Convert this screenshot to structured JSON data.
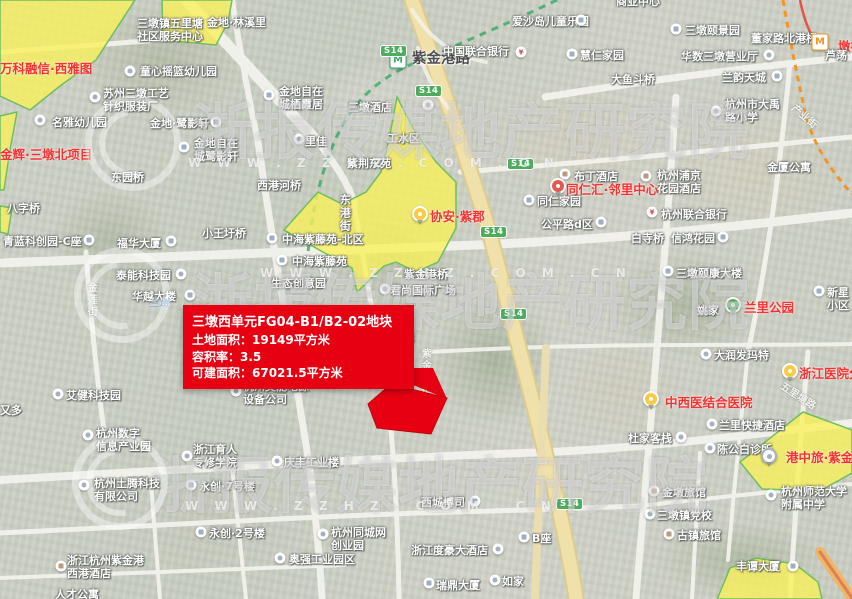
{
  "colors": {
    "zone_fill": "#f8ee3c",
    "zone_stroke": "#56b344",
    "parcel_red": "#e60012",
    "metro_line_green": "#1d9e53",
    "metro_line_orange": "#f08300",
    "metro_line_red": "#e3342b",
    "shield_green": "#2f9e41",
    "highway_yellow": "#eedc9d"
  },
  "infobox": {
    "title": "三墩西单元FG04-B1/B2-02地块",
    "lines": [
      "土地面积：19149平方米",
      "容积率：3.5",
      "可建面积：67021.5平方米"
    ]
  },
  "watermark": {
    "brand": "浙报传媒地产研究院",
    "url": "W W W . Z Z H Z . C O M . C N",
    "rows": [
      {
        "x": 192,
        "y": 82
      },
      {
        "x": 192,
        "y": 253
      },
      {
        "x": 150,
        "y": 436
      }
    ],
    "urls": [
      {
        "x": 188,
        "y": 156
      },
      {
        "x": 260,
        "y": 266
      },
      {
        "x": 185,
        "y": 499
      }
    ],
    "logos": [
      {
        "x": 133,
        "y": 143
      },
      {
        "x": 122,
        "y": 295
      },
      {
        "x": 120,
        "y": 482
      }
    ]
  },
  "map": {
    "road_shield": "S14",
    "pin_glyphs": {
      "bank": "¥",
      "mg": "M",
      "mo": "M"
    },
    "shields": [
      {
        "x": 380,
        "y": 45
      },
      {
        "x": 415,
        "y": 85
      },
      {
        "x": 507,
        "y": 158
      },
      {
        "x": 480,
        "y": 226
      },
      {
        "x": 500,
        "y": 308
      },
      {
        "x": 556,
        "y": 498
      }
    ],
    "zones": [
      {
        "points": "0,0 135,0 96,60 60,86 30,110 0,96"
      },
      {
        "points": "0,116 17,112 10,150 4,190 0,190"
      },
      {
        "points": "0,206 12,208 8,234 0,232"
      },
      {
        "points": "162,0 232,0 228,22 216,45 163,40"
      },
      {
        "points": "397,97 413,128 436,162 456,182 456,228 438,262 416,272 396,262 384,266 357,292 352,268 330,256 284,230 318,192 342,204 366,192 381,172 389,140"
      },
      {
        "points": "803,412 852,430 852,473 820,491 762,489 740,462"
      },
      {
        "points": "718,597 730,568 756,558 795,564 818,582 822,599 718,599"
      }
    ],
    "parcel": {
      "name": "三墩西单元FG04-B1/B2-02地块",
      "points": "368,404 391,384 447,398 431,434 377,428",
      "tail": "390,368 433,368 447,399 406,382"
    },
    "labels": [
      {
        "t": "万科融信·西雅图",
        "x": 0,
        "y": 61,
        "c": "r"
      },
      {
        "t": "金辉·三墩北项目",
        "x": 0,
        "y": 147,
        "c": "r"
      },
      {
        "t": "协安·紫郡",
        "x": 430,
        "y": 209,
        "c": "r"
      },
      {
        "t": "同仁汇·邻里中心",
        "x": 566,
        "y": 182,
        "c": "r"
      },
      {
        "t": "兰里公园",
        "x": 744,
        "y": 300,
        "c": "r"
      },
      {
        "t": "浙江医院分院",
        "x": 799,
        "y": 366,
        "c": "r"
      },
      {
        "t": "中西医结合医院",
        "x": 665,
        "y": 395,
        "c": "r"
      },
      {
        "t": "港中旅·紫金湾",
        "x": 786,
        "y": 450,
        "c": "r"
      },
      {
        "t": "墩祥街",
        "x": 838,
        "y": 39,
        "c": "r"
      },
      {
        "t": "紫金港路",
        "x": 412,
        "y": 51,
        "c": "st"
      },
      {
        "t": "三墩镇五里塘\n社区服务中心",
        "x": 137,
        "y": 17,
        "c": "p"
      },
      {
        "t": "金地·林溪里",
        "x": 207,
        "y": 16,
        "c": "p"
      },
      {
        "t": "童心摇篮幼儿园",
        "x": 140,
        "y": 65,
        "c": "p"
      },
      {
        "t": "苏州三墩工艺\n针织服装厂",
        "x": 103,
        "y": 87,
        "c": "p"
      },
      {
        "t": "名雅幼儿园",
        "x": 52,
        "y": 116,
        "c": "p"
      },
      {
        "t": "金地·鹭影轩",
        "x": 150,
        "y": 117,
        "c": "p"
      },
      {
        "t": "金地自在\n城鹭影轩",
        "x": 194,
        "y": 137,
        "c": "p"
      },
      {
        "t": "金地自在\n城栖霞居",
        "x": 279,
        "y": 85,
        "c": "p"
      },
      {
        "t": "东园桥",
        "x": 111,
        "y": 171,
        "c": "p"
      },
      {
        "t": "八字桥",
        "x": 7,
        "y": 202,
        "c": "p"
      },
      {
        "t": "青蓝科创园-C座",
        "x": 3,
        "y": 235,
        "c": "p"
      },
      {
        "t": "福华大厦",
        "x": 117,
        "y": 237,
        "c": "p"
      },
      {
        "t": "泰能科技园",
        "x": 116,
        "y": 269,
        "c": "p"
      },
      {
        "t": "华越大楼",
        "x": 132,
        "y": 290,
        "c": "p"
      },
      {
        "t": "小王圩桥",
        "x": 202,
        "y": 227,
        "c": "p"
      },
      {
        "t": "中海紫藤苑-北区",
        "x": 282,
        "y": 233,
        "c": "p"
      },
      {
        "t": "中海紫藤苑",
        "x": 292,
        "y": 255,
        "c": "p"
      },
      {
        "t": "生态创意园",
        "x": 271,
        "y": 277,
        "c": "p"
      },
      {
        "t": "西港河桥",
        "x": 257,
        "y": 179,
        "c": "p"
      },
      {
        "t": "东港街",
        "x": 338,
        "y": 194,
        "c": "p",
        "v": 1
      },
      {
        "t": "紫荆东苑",
        "x": 347,
        "y": 157,
        "c": "p"
      },
      {
        "t": "三墩酒店",
        "x": 348,
        "y": 101,
        "c": "p"
      },
      {
        "t": "工水区",
        "x": 387,
        "y": 132,
        "c": "p"
      },
      {
        "t": "里佳",
        "x": 305,
        "y": 135,
        "c": "p"
      },
      {
        "t": "爱沙岛儿童乐园",
        "x": 512,
        "y": 15,
        "c": "p"
      },
      {
        "t": "中国联合银行",
        "x": 443,
        "y": 45,
        "c": "p"
      },
      {
        "t": "商业中心",
        "x": 616,
        "y": -5,
        "c": "p"
      },
      {
        "t": "三墩颐景园",
        "x": 685,
        "y": 24,
        "c": "p"
      },
      {
        "t": "董家路北港桥",
        "x": 751,
        "y": 32,
        "c": "p"
      },
      {
        "t": "慧仁家园",
        "x": 580,
        "y": 49,
        "c": "p"
      },
      {
        "t": "华数三墩营业厅",
        "x": 681,
        "y": 50,
        "c": "p"
      },
      {
        "t": "兰韵天城",
        "x": 722,
        "y": 71,
        "c": "p"
      },
      {
        "t": "大鱼斗桥",
        "x": 611,
        "y": 73,
        "c": "p"
      },
      {
        "t": "杭州市大禹\n路小学",
        "x": 725,
        "y": 98,
        "c": "p"
      },
      {
        "t": "金厦公寓",
        "x": 767,
        "y": 161,
        "c": "p"
      },
      {
        "t": "杭州浦京\n花园酒店",
        "x": 657,
        "y": 169,
        "c": "p"
      },
      {
        "t": "布丁酒店",
        "x": 574,
        "y": 170,
        "c": "p"
      },
      {
        "t": "同仁家园",
        "x": 537,
        "y": 195,
        "c": "p"
      },
      {
        "t": "公平路d区",
        "x": 541,
        "y": 218,
        "c": "p"
      },
      {
        "t": "杭州联合银行",
        "x": 661,
        "y": 208,
        "c": "p"
      },
      {
        "t": "白寺桥",
        "x": 631,
        "y": 232,
        "c": "p"
      },
      {
        "t": "信鸿花园",
        "x": 671,
        "y": 232,
        "c": "p"
      },
      {
        "t": "三墩颐康大楼",
        "x": 676,
        "y": 267,
        "c": "p"
      },
      {
        "t": "新星小区",
        "x": 827,
        "y": 286,
        "c": "p"
      },
      {
        "t": "姚家",
        "x": 697,
        "y": 304,
        "c": "p"
      },
      {
        "t": "大润发玛特",
        "x": 714,
        "y": 349,
        "c": "p"
      },
      {
        "t": "兰里快捷酒店",
        "x": 719,
        "y": 419,
        "c": "p"
      },
      {
        "t": "陈公白诊所",
        "x": 717,
        "y": 443,
        "c": "p"
      },
      {
        "t": "杜家客栈",
        "x": 628,
        "y": 432,
        "c": "p"
      },
      {
        "t": "金墩旅馆",
        "x": 662,
        "y": 486,
        "c": "p"
      },
      {
        "t": "三墩镇党校",
        "x": 657,
        "y": 509,
        "c": "p"
      },
      {
        "t": "古镇旅馆",
        "x": 677,
        "y": 529,
        "c": "p"
      },
      {
        "t": "丰谭大厦",
        "x": 736,
        "y": 560,
        "c": "p"
      },
      {
        "t": "杭州师范大学\n附属中学",
        "x": 781,
        "y": 485,
        "c": "p"
      },
      {
        "t": "西城博司",
        "x": 421,
        "y": 496,
        "c": "p"
      },
      {
        "t": "B座",
        "x": 532,
        "y": 532,
        "c": "p"
      },
      {
        "t": "浙江度豪大酒店",
        "x": 411,
        "y": 544,
        "c": "p"
      },
      {
        "t": "瑞鼎大厦",
        "x": 436,
        "y": 579,
        "c": "p"
      },
      {
        "t": "如家",
        "x": 502,
        "y": 575,
        "c": "p"
      },
      {
        "t": "杭州同城网\n创业园",
        "x": 331,
        "y": 526,
        "c": "p"
      },
      {
        "t": "奥强工业园区",
        "x": 289,
        "y": 553,
        "c": "p"
      },
      {
        "t": "庆丰工业楼",
        "x": 284,
        "y": 456,
        "c": "p"
      },
      {
        "t": "永创·7号楼",
        "x": 199,
        "y": 480,
        "c": "p"
      },
      {
        "t": "永创·2号楼",
        "x": 209,
        "y": 527,
        "c": "p"
      },
      {
        "t": "浙江育人\n专修学院",
        "x": 193,
        "y": 443,
        "c": "p"
      },
      {
        "t": "杭州数字\n信息产业园",
        "x": 96,
        "y": 427,
        "c": "p"
      },
      {
        "t": "杭州土腾科技\n有限公司",
        "x": 94,
        "y": 477,
        "c": "p"
      },
      {
        "t": "浙江杭州紫金港\n西港酒店",
        "x": 67,
        "y": 554,
        "c": "p"
      },
      {
        "t": "人才公寓",
        "x": 55,
        "y": 588,
        "c": "p"
      },
      {
        "t": "艾健科技园",
        "x": 66,
        "y": 389,
        "c": "p"
      },
      {
        "t": "又多",
        "x": 0,
        "y": 404,
        "c": "p"
      },
      {
        "t": "杭州奥能电源\n设备公司",
        "x": 243,
        "y": 380,
        "c": "p"
      },
      {
        "t": "君尚国际广场",
        "x": 390,
        "y": 284,
        "c": "p"
      },
      {
        "t": "紫金港桥",
        "x": 404,
        "y": 268,
        "c": "p"
      },
      {
        "t": "国际",
        "x": 392,
        "y": 331,
        "c": "p"
      },
      {
        "t": "三墩",
        "x": 149,
        "y": 299,
        "c": "bl"
      },
      {
        "t": "芦荡",
        "x": 825,
        "y": 49,
        "c": "p"
      },
      {
        "t": "金莲街",
        "x": 84,
        "y": 282,
        "c": "rd",
        "v": 1
      },
      {
        "t": "产业街",
        "x": 796,
        "y": 103,
        "c": "rd",
        "rot": 40
      },
      {
        "t": "五里塘路",
        "x": 784,
        "y": 381,
        "c": "rd",
        "rot": 33
      },
      {
        "t": "紫金港街",
        "x": 418,
        "y": 348,
        "c": "rd",
        "v": 1
      }
    ],
    "pins": [
      {
        "x": 130,
        "y": 71,
        "k": "dot"
      },
      {
        "x": 95,
        "y": 97,
        "k": "dot"
      },
      {
        "x": 40,
        "y": 120,
        "k": "dot"
      },
      {
        "x": 216,
        "y": 122,
        "k": "b"
      },
      {
        "x": 184,
        "y": 147,
        "k": "b"
      },
      {
        "x": 269,
        "y": 95,
        "k": "b"
      },
      {
        "x": 89,
        "y": 240,
        "k": "b"
      },
      {
        "x": 171,
        "y": 241,
        "k": "b"
      },
      {
        "x": 181,
        "y": 274,
        "k": "dot"
      },
      {
        "x": 190,
        "y": 295,
        "k": "b"
      },
      {
        "x": 58,
        "y": 394,
        "k": "dot"
      },
      {
        "x": 272,
        "y": 238,
        "k": "b"
      },
      {
        "x": 282,
        "y": 260,
        "k": "b"
      },
      {
        "x": 420,
        "y": 214,
        "k": "py"
      },
      {
        "x": 398,
        "y": 60,
        "k": "mg"
      },
      {
        "x": 820,
        "y": 42,
        "k": "mo"
      },
      {
        "x": 521,
        "y": 52,
        "k": "bank"
      },
      {
        "x": 581,
        "y": 20,
        "k": "b"
      },
      {
        "x": 676,
        "y": 29,
        "k": "b"
      },
      {
        "x": 572,
        "y": 54,
        "k": "b"
      },
      {
        "x": 769,
        "y": 55,
        "k": "dot"
      },
      {
        "x": 777,
        "y": 76,
        "k": "b"
      },
      {
        "x": 716,
        "y": 111,
        "k": "dot"
      },
      {
        "x": 646,
        "y": 176,
        "k": "h"
      },
      {
        "x": 565,
        "y": 174,
        "k": "h"
      },
      {
        "x": 558,
        "y": 186,
        "k": "pr"
      },
      {
        "x": 529,
        "y": 200,
        "k": "b"
      },
      {
        "x": 601,
        "y": 222,
        "k": "b"
      },
      {
        "x": 652,
        "y": 212,
        "k": "bank"
      },
      {
        "x": 723,
        "y": 237,
        "k": "b"
      },
      {
        "x": 668,
        "y": 271,
        "k": "b"
      },
      {
        "x": 819,
        "y": 291,
        "k": "b"
      },
      {
        "x": 733,
        "y": 305,
        "k": "pg"
      },
      {
        "x": 706,
        "y": 354,
        "k": "dot"
      },
      {
        "x": 790,
        "y": 371,
        "k": "py"
      },
      {
        "x": 651,
        "y": 399,
        "k": "py"
      },
      {
        "x": 712,
        "y": 424,
        "k": "dot"
      },
      {
        "x": 710,
        "y": 448,
        "k": "dot"
      },
      {
        "x": 681,
        "y": 437,
        "k": "dot"
      },
      {
        "x": 769,
        "y": 456,
        "k": "pw"
      },
      {
        "x": 771,
        "y": 495,
        "k": "dot"
      },
      {
        "x": 654,
        "y": 491,
        "k": "h"
      },
      {
        "x": 650,
        "y": 514,
        "k": "dot"
      },
      {
        "x": 669,
        "y": 534,
        "k": "h"
      },
      {
        "x": 793,
        "y": 566,
        "k": "b"
      },
      {
        "x": 475,
        "y": 501,
        "k": "b"
      },
      {
        "x": 498,
        "y": 549,
        "k": "dot"
      },
      {
        "x": 524,
        "y": 537,
        "k": "b"
      },
      {
        "x": 429,
        "y": 583,
        "k": "b"
      },
      {
        "x": 495,
        "y": 580,
        "k": "dot"
      },
      {
        "x": 323,
        "y": 534,
        "k": "dot"
      },
      {
        "x": 280,
        "y": 558,
        "k": "dot"
      },
      {
        "x": 277,
        "y": 461,
        "k": "dot"
      },
      {
        "x": 191,
        "y": 485,
        "k": "b"
      },
      {
        "x": 201,
        "y": 532,
        "k": "b"
      },
      {
        "x": 187,
        "y": 456,
        "k": "dot"
      },
      {
        "x": 88,
        "y": 435,
        "k": "dot"
      },
      {
        "x": 84,
        "y": 485,
        "k": "dot"
      },
      {
        "x": 61,
        "y": 566,
        "k": "h"
      },
      {
        "x": 236,
        "y": 391,
        "k": "dot"
      },
      {
        "x": 385,
        "y": 289,
        "k": "dot"
      },
      {
        "x": 428,
        "y": 105,
        "k": "dot"
      },
      {
        "x": 299,
        "y": 139,
        "k": "dot"
      }
    ]
  }
}
